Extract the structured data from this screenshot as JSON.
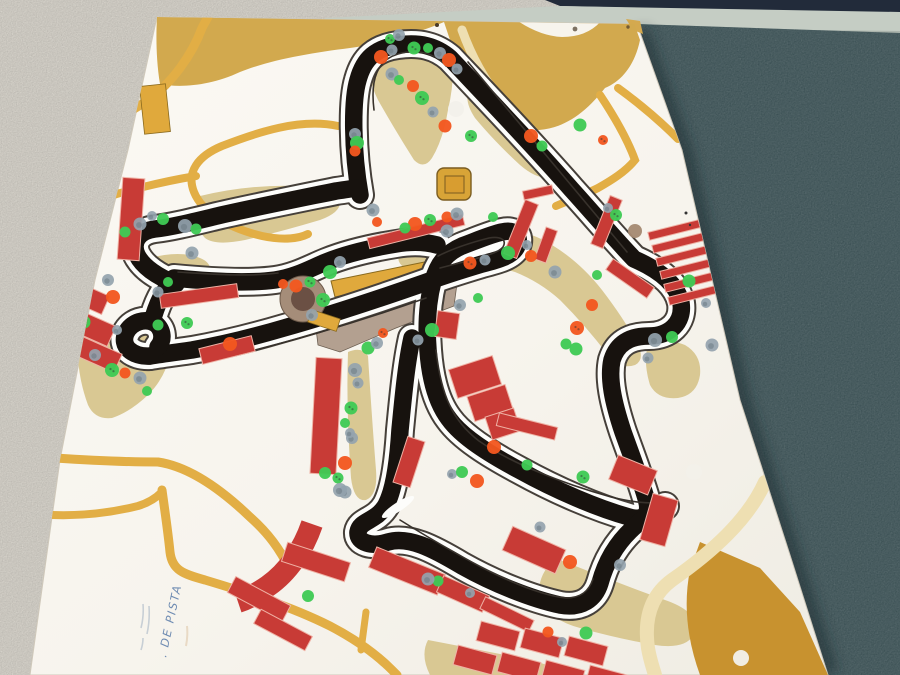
{
  "scene": {
    "label": "race-circuit-map-board-photo",
    "annotation": {
      "text": ". DE PISTA"
    }
  },
  "palette": {
    "wall_white": "#e9e5dc",
    "wall_teal": "#2c4347",
    "navy_strip": "#222b3a",
    "trim_bar": "#c5cdc4",
    "board_white": "#f7f4ed",
    "track_black": "#17120e",
    "road_yellow": "#e2ae45",
    "road_pale": "#eedfb2",
    "terrain_khaki": "#d9c893",
    "terrain_mustard": "#d2a94e",
    "gold_area": "#c8922f",
    "paddock_tan": "#b3a090",
    "building_red": "#c83b36",
    "building_stroke": "#efb2a5",
    "grandstand_gold": "#e0a93c",
    "circle_outer": "#a58d79",
    "circle_inner": "#6b5044",
    "sticker_green": "#3fca54",
    "sticker_orange": "#f2571f",
    "sticker_slate": "#94a3ae",
    "sticker_brown": "#a58a72",
    "sticker_white": "#f2f0ea",
    "handwriting_blue": "#587aa8"
  },
  "stickers": [
    [
      390,
      39,
      "g"
    ],
    [
      399,
      35,
      "s"
    ],
    [
      381,
      57,
      "o"
    ],
    [
      392,
      50,
      "s"
    ],
    [
      414,
      48,
      "g"
    ],
    [
      428,
      48,
      "g"
    ],
    [
      440,
      53,
      "s"
    ],
    [
      449,
      60,
      "o"
    ],
    [
      457,
      69,
      "s"
    ],
    [
      392,
      74,
      "s"
    ],
    [
      399,
      80,
      "g"
    ],
    [
      413,
      86,
      "o"
    ],
    [
      422,
      98,
      "g"
    ],
    [
      433,
      112,
      "s"
    ],
    [
      445,
      126,
      "o"
    ],
    [
      456,
      109,
      "w"
    ],
    [
      471,
      136,
      "g"
    ],
    [
      531,
      136,
      "o"
    ],
    [
      542,
      146,
      "g"
    ],
    [
      580,
      125,
      "g"
    ],
    [
      603,
      140,
      "o"
    ],
    [
      355,
      134,
      "s"
    ],
    [
      357,
      143,
      "g"
    ],
    [
      355,
      151,
      "o"
    ],
    [
      373,
      210,
      "s"
    ],
    [
      377,
      222,
      "o"
    ],
    [
      340,
      262,
      "s"
    ],
    [
      330,
      272,
      "g"
    ],
    [
      310,
      282,
      "g"
    ],
    [
      296,
      286,
      "o"
    ],
    [
      283,
      284,
      "o"
    ],
    [
      312,
      315,
      "s"
    ],
    [
      323,
      300,
      "g"
    ],
    [
      447,
      217,
      "o"
    ],
    [
      457,
      214,
      "s"
    ],
    [
      493,
      217,
      "g"
    ],
    [
      430,
      220,
      "g"
    ],
    [
      415,
      224,
      "o"
    ],
    [
      405,
      228,
      "g"
    ],
    [
      447,
      231,
      "s"
    ],
    [
      527,
      245,
      "s"
    ],
    [
      531,
      256,
      "o"
    ],
    [
      508,
      253,
      "g"
    ],
    [
      485,
      260,
      "s"
    ],
    [
      470,
      263,
      "o"
    ],
    [
      478,
      298,
      "g"
    ],
    [
      460,
      305,
      "s"
    ],
    [
      432,
      330,
      "g"
    ],
    [
      418,
      340,
      "s"
    ],
    [
      555,
      272,
      "s"
    ],
    [
      597,
      275,
      "g"
    ],
    [
      592,
      305,
      "o"
    ],
    [
      577,
      328,
      "o"
    ],
    [
      566,
      344,
      "g"
    ],
    [
      576,
      349,
      "g"
    ],
    [
      608,
      208,
      "s"
    ],
    [
      616,
      215,
      "g"
    ],
    [
      635,
      231,
      "b"
    ],
    [
      125,
      232,
      "g"
    ],
    [
      140,
      224,
      "s"
    ],
    [
      152,
      216,
      "s"
    ],
    [
      163,
      219,
      "g"
    ],
    [
      185,
      226,
      "s"
    ],
    [
      196,
      229,
      "g"
    ],
    [
      192,
      253,
      "s"
    ],
    [
      168,
      282,
      "g"
    ],
    [
      108,
      280,
      "s"
    ],
    [
      113,
      297,
      "o"
    ],
    [
      158,
      292,
      "s"
    ],
    [
      84,
      322,
      "g"
    ],
    [
      117,
      330,
      "s"
    ],
    [
      95,
      355,
      "s"
    ],
    [
      112,
      370,
      "g"
    ],
    [
      125,
      373,
      "o"
    ],
    [
      140,
      378,
      "s"
    ],
    [
      147,
      391,
      "g"
    ],
    [
      187,
      323,
      "g"
    ],
    [
      230,
      344,
      "o"
    ],
    [
      158,
      325,
      "g"
    ],
    [
      368,
      348,
      "g"
    ],
    [
      383,
      333,
      "o"
    ],
    [
      377,
      343,
      "s"
    ],
    [
      355,
      370,
      "s"
    ],
    [
      358,
      383,
      "s"
    ],
    [
      351,
      408,
      "g"
    ],
    [
      345,
      423,
      "g"
    ],
    [
      352,
      438,
      "s"
    ],
    [
      345,
      463,
      "o"
    ],
    [
      338,
      478,
      "g"
    ],
    [
      345,
      492,
      "s"
    ],
    [
      350,
      433,
      "s"
    ],
    [
      325,
      473,
      "g"
    ],
    [
      340,
      490,
      "s"
    ],
    [
      438,
      581,
      "g"
    ],
    [
      428,
      579,
      "s"
    ],
    [
      470,
      593,
      "s"
    ],
    [
      620,
      565,
      "s"
    ],
    [
      570,
      562,
      "o"
    ],
    [
      548,
      632,
      "o"
    ],
    [
      586,
      633,
      "g"
    ],
    [
      562,
      642,
      "s"
    ],
    [
      308,
      596,
      "g"
    ],
    [
      494,
      447,
      "o"
    ],
    [
      527,
      465,
      "g"
    ],
    [
      583,
      477,
      "g"
    ],
    [
      452,
      474,
      "s"
    ],
    [
      462,
      472,
      "g"
    ],
    [
      477,
      481,
      "o"
    ],
    [
      540,
      527,
      "s"
    ],
    [
      689,
      281,
      "g"
    ],
    [
      706,
      303,
      "s"
    ],
    [
      672,
      337,
      "g"
    ],
    [
      655,
      340,
      "s"
    ],
    [
      648,
      358,
      "s"
    ],
    [
      712,
      345,
      "s"
    ],
    [
      694,
      472,
      "w"
    ],
    [
      741,
      658,
      "w"
    ]
  ],
  "buildings": [
    [
      120,
      178,
      22,
      82,
      4
    ],
    [
      78,
      232,
      16,
      22,
      8
    ],
    [
      52,
      284,
      56,
      20,
      24
    ],
    [
      58,
      314,
      56,
      22,
      24
    ],
    [
      74,
      344,
      46,
      20,
      24
    ],
    [
      160,
      289,
      78,
      14,
      -8
    ],
    [
      200,
      342,
      54,
      16,
      -14
    ],
    [
      313,
      358,
      26,
      116,
      3
    ],
    [
      367,
      226,
      98,
      11,
      -14
    ],
    [
      514,
      200,
      14,
      58,
      22
    ],
    [
      540,
      228,
      12,
      34,
      20
    ],
    [
      600,
      196,
      13,
      52,
      22
    ],
    [
      605,
      272,
      50,
      13,
      35
    ],
    [
      436,
      312,
      22,
      26,
      8
    ],
    [
      523,
      188,
      30,
      9,
      -12
    ],
    [
      452,
      362,
      46,
      30,
      -18
    ],
    [
      470,
      390,
      40,
      26,
      -18
    ],
    [
      488,
      412,
      30,
      24,
      -18
    ],
    [
      400,
      438,
      18,
      48,
      18
    ],
    [
      497,
      420,
      60,
      13,
      14
    ],
    [
      505,
      537,
      58,
      26,
      24
    ],
    [
      370,
      560,
      74,
      22,
      22
    ],
    [
      438,
      585,
      50,
      18,
      24
    ],
    [
      480,
      608,
      54,
      13,
      26
    ],
    [
      283,
      552,
      66,
      20,
      18
    ],
    [
      228,
      590,
      62,
      18,
      28
    ],
    [
      254,
      622,
      58,
      16,
      28
    ],
    [
      612,
      462,
      42,
      26,
      22
    ],
    [
      646,
      496,
      26,
      48,
      16
    ],
    [
      478,
      626,
      40,
      20,
      15
    ],
    [
      522,
      633,
      40,
      20,
      15
    ],
    [
      566,
      641,
      40,
      20,
      15
    ],
    [
      455,
      650,
      40,
      20,
      15
    ],
    [
      499,
      657,
      40,
      20,
      15
    ],
    [
      543,
      665,
      40,
      20,
      15
    ],
    [
      587,
      670,
      40,
      20,
      15
    ],
    [
      648,
      226,
      52,
      8,
      -14
    ],
    [
      652,
      239,
      52,
      8,
      -14
    ],
    [
      656,
      252,
      52,
      8,
      -14
    ],
    [
      660,
      265,
      52,
      8,
      -14
    ],
    [
      664,
      278,
      52,
      8,
      -14
    ],
    [
      668,
      291,
      52,
      8,
      -14
    ]
  ],
  "gold_rects": [
    [
      142,
      85,
      26,
      48,
      -6
    ],
    [
      309,
      314,
      30,
      13,
      18
    ]
  ]
}
